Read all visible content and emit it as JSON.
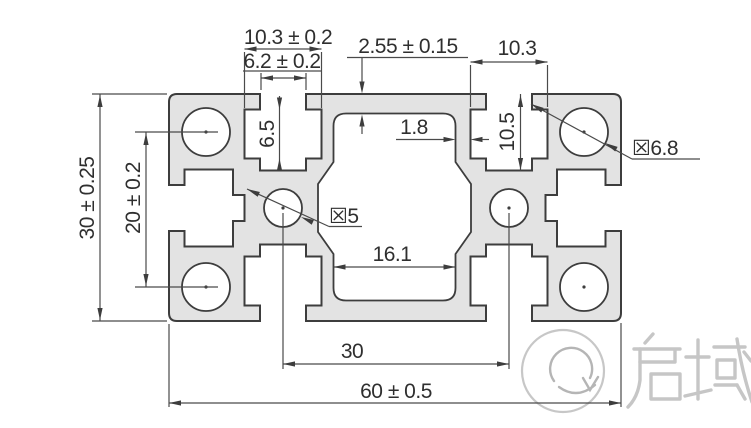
{
  "drawing": {
    "title": "aluminium-profile-3060-cross-section",
    "dims": {
      "top_slot_inner_width": "10.3 ± 0.2",
      "top_slot_opening": "6.2 ± 0.2",
      "outer_wall_thickness": "2.55 ± 0.15",
      "corner_face_width": "10.3",
      "slot_cavity_height": "6.5",
      "slot_total_depth": "10.5",
      "rib_thickness": "1.8",
      "center_hole_dia": "☒5",
      "corner_hole_dia": "☒6.8",
      "center_cavity_width": "16.1",
      "profile_height": "30 ± 0.25",
      "corner_hole_spacing": "20 ± 0.2",
      "center_hole_spacing": "30",
      "profile_width": "60 ± 0.5"
    },
    "colors": {
      "profile_fill": "#e3e3e3",
      "outline": "#3d3d3d",
      "dimension_lines": "#4a4a4a",
      "text": "#2f2f2f",
      "logo": "#c6c6c6"
    },
    "logo": {
      "text": "启域",
      "mark": "q-swirl-logo"
    }
  }
}
